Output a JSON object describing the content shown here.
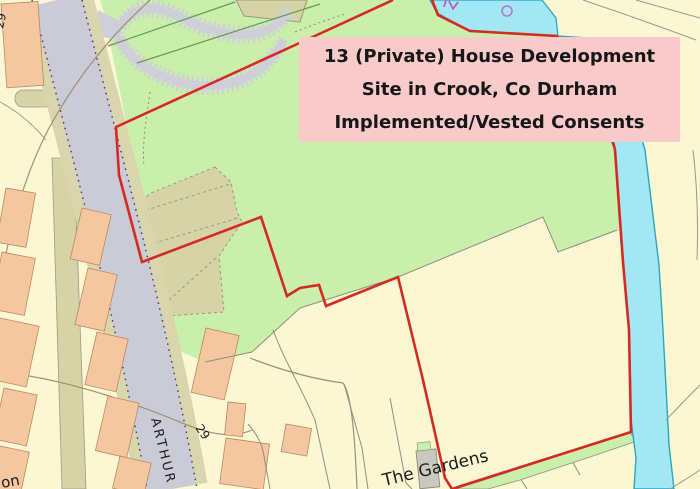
{
  "overlay_box": {
    "line1": "13 (Private) House Development",
    "line2": "Site in Crook, Co Durham",
    "line3": "Implemented/Vested Consents"
  },
  "labels": {
    "street_name": "ARTHUR",
    "place_name": "The Gardens",
    "house_number_top": "29",
    "house_number_road": "29",
    "street_fragment": "on"
  },
  "colors": {
    "site_boundary_red": "#D52A21",
    "overlay_pink": "#F8CAC9",
    "water_fill": "#A4E7F4",
    "water_edge": "#2BA6BD",
    "greenspace": "#C9EFAA",
    "parcel_cream": "#FBF7D3",
    "road_grey": "#CBCBD7",
    "path_khaki": "#D6D3A6",
    "building_orange": "#F4C7A0",
    "building_edge": "#B9895F",
    "plot_line_grey": "#8F8F80",
    "contour_brown": "#A08D72",
    "magenta_marks": "#C050C2",
    "hedge_green": "#6A9A52"
  }
}
